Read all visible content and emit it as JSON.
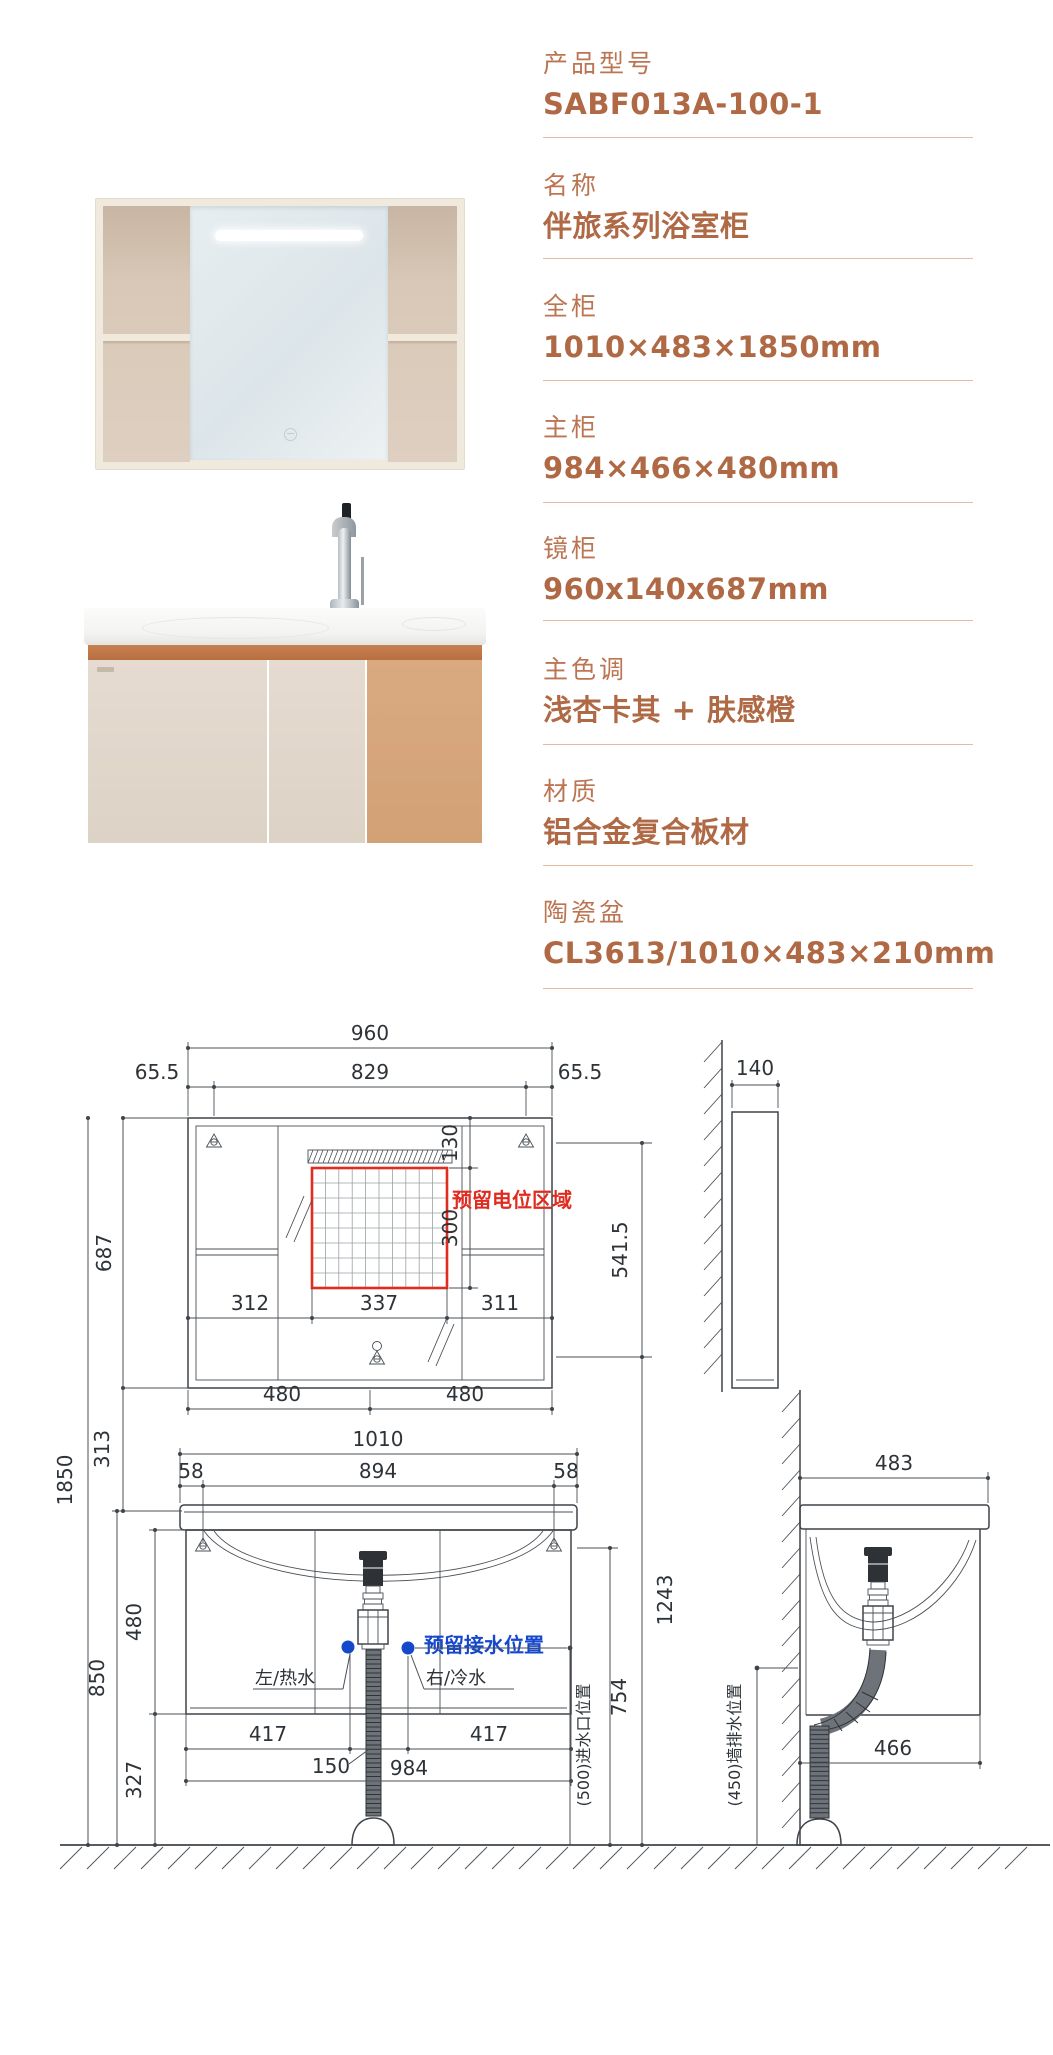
{
  "specs": {
    "accent": "#B4704E",
    "rows": [
      {
        "label": "产品型号",
        "value": "SABF013A-100-1"
      },
      {
        "label": "名称",
        "value": "伴旅系列浴室柜"
      },
      {
        "label": "全柜",
        "value": "1010×483×1850mm"
      },
      {
        "label": "主柜",
        "value": "984×466×480mm"
      },
      {
        "label": "镜柜",
        "value": "960x140x687mm"
      },
      {
        "label": "主色调",
        "value": "浅杏卡其 + 肤感橙"
      },
      {
        "label": "材质",
        "value": "铝合金复合板材"
      },
      {
        "label": "陶瓷盆",
        "value": "CL3613/1010×483×210mm"
      }
    ]
  },
  "drawing": {
    "colors": {
      "line": "#3E444A",
      "red": "#E02B20",
      "blue": "#1648CC"
    },
    "mirror_front": {
      "width": "960",
      "bracket_left": "65.5",
      "inner": "829",
      "bracket_right": "65.5",
      "height": "687",
      "led_gap": "130",
      "zone_height": "300",
      "seg_left": "312",
      "seg_mid": "337",
      "seg_right": "311",
      "half_left": "480",
      "half_right": "480",
      "zone_label": "预留电位区域"
    },
    "mirror_side": {
      "depth": "140",
      "drop": "541.5"
    },
    "vanity_front": {
      "total_height": "1850",
      "gap": "313",
      "width": "1010",
      "margin_left": "58",
      "inner": "894",
      "margin_right": "58",
      "cabinet_height": "480",
      "counter_height": "850",
      "clearance": "327",
      "foot_left": "417",
      "drain_offset": "150",
      "foot_right": "417",
      "body_width": "984",
      "outlet_height": "754",
      "riser_height": "1243",
      "hot_label": "左/热水",
      "cold_label": "右/冷水",
      "water_label": "预留接水位置",
      "inlet_label": "(500)进水口位置",
      "wall_drain_label": "(450)墙排水位置"
    },
    "vanity_side": {
      "depth_top": "483",
      "depth_bottom": "466"
    }
  }
}
